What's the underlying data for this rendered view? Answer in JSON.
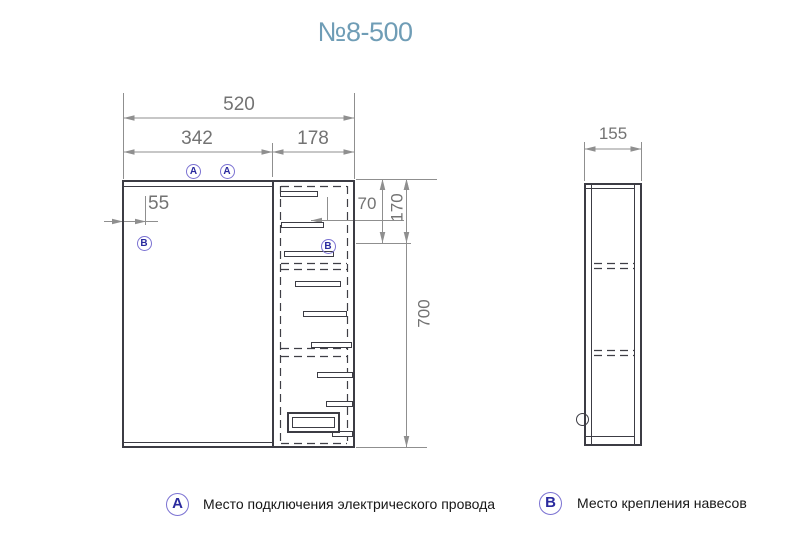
{
  "title": "№8-500",
  "front_view": {
    "dims": {
      "overall_width": "520",
      "mirror_width": "342",
      "cabinet_width": "178",
      "hinge_offset": "55",
      "shelf_top": "70",
      "shelf_second": "170",
      "height": "700"
    },
    "markers": {
      "a": "A",
      "b": "B"
    }
  },
  "side_view": {
    "dims": {
      "depth": "155"
    }
  },
  "legend": {
    "a": {
      "symbol": "A",
      "label": "Место подключения электрического провода"
    },
    "b": {
      "symbol": "B",
      "label": "Место крепления навесов"
    }
  },
  "colors": {
    "title": "#6f9db6",
    "object_line": "#3c3c44",
    "dim_line": "#8f8f8f",
    "dim_text": "#737373",
    "marker_stroke": "#7b72d2",
    "marker_text": "#2a2a9e"
  }
}
